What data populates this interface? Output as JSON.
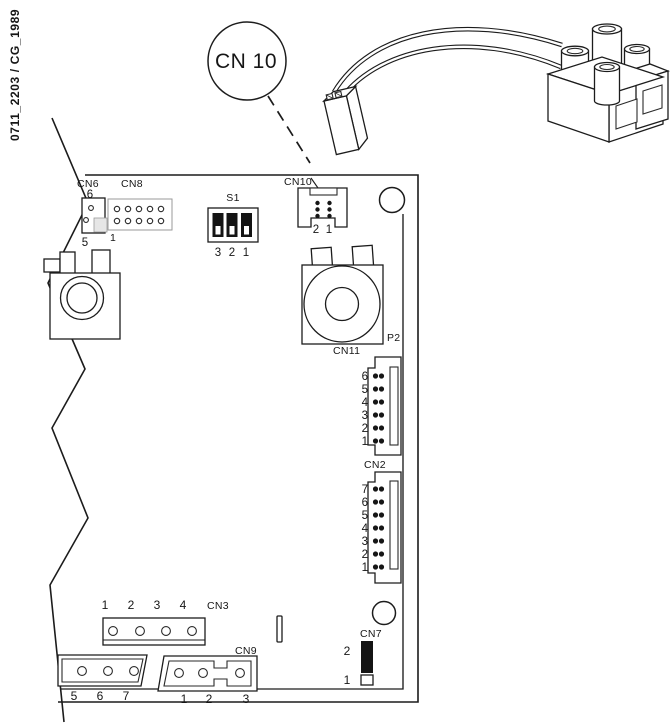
{
  "doc_code": "0711_2203 / CG_1989",
  "callout": {
    "label": "CN 10"
  },
  "board": {
    "cn6": {
      "label": "CN6",
      "pin_top": "6",
      "pin_bottom": "5"
    },
    "cn8": {
      "label": "CN8",
      "pin_first": "1"
    },
    "s1": {
      "label": "S1",
      "pins": [
        "3",
        "2",
        "1"
      ]
    },
    "cn10": {
      "label": "CN10",
      "pins": [
        "2",
        "1"
      ]
    },
    "p2": {
      "label": "P2"
    },
    "cn11": {
      "label": "CN11",
      "pins": [
        "6",
        "5",
        "4",
        "3",
        "2",
        "1"
      ]
    },
    "cn2": {
      "label": "CN2",
      "pins": [
        "7",
        "6",
        "5",
        "4",
        "3",
        "2",
        "1"
      ]
    },
    "cn3": {
      "label": "CN3",
      "pins": [
        "1",
        "2",
        "3",
        "4"
      ]
    },
    "cn_edge": {
      "pins": [
        "5",
        "6",
        "7"
      ]
    },
    "cn9": {
      "label": "CN9",
      "pins": [
        "1",
        "2",
        "3"
      ]
    },
    "cn7": {
      "label": "CN7",
      "pin_top": "2",
      "pin_bottom": "1"
    }
  },
  "colors": {
    "line": "#1c1c1c",
    "background": "#ffffff"
  }
}
